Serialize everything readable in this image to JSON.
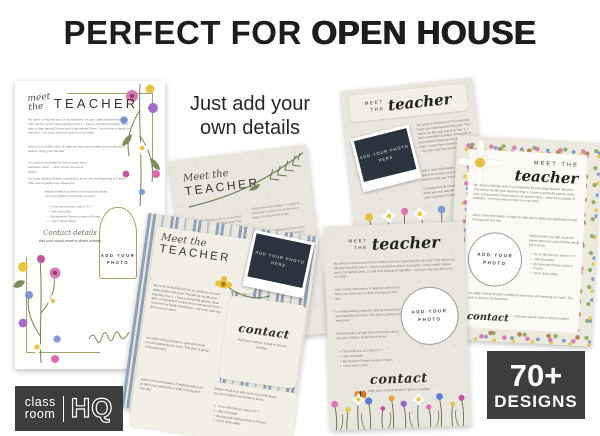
{
  "header": {
    "title_regular": "PERFECT FOR",
    "title_bold": "OPEN HOUSE"
  },
  "captions": {
    "just_add": "Just add your own details",
    "pages": "Pages of designs to choose from"
  },
  "badges": {
    "designs_count": "70+",
    "designs_label": "DESIGNS",
    "logo_top": "class",
    "logo_bottom": "room",
    "logo_hq": "HQ"
  },
  "placeholders": {
    "add_photo": "ADD YOUR PHOTO",
    "add_photo_here": "ADD YOUR PHOTO HERE"
  },
  "copy": {
    "intro": "My name is Nichola and I'm so excited to be your class teacher this year! This will be my 8th year teaching Year 1. I have a wonderful partner, three girls, a dog named Cooper and a cat named Clem. I come from a family of teachers – my mum was one and so is my sister.",
    "more_info": "Add in more information. It might be able how to label your textbooks or what to bring your first day.",
    "filler": "Just add more details And then some more and Even more ... Until you've run out of space.",
    "closing": "I'm really looking forward to getting to know you and watching you learn. This year is going to be awesome!",
    "dot_points": "Maybe break it up with some dot points about you your children would like to know",
    "bullets": [
      "I'm so tall now as I was in Yr 7",
      "I like chocolate",
      "My favourite Disney movie is Frozen",
      "I don't drink coffee"
    ],
    "contact_sub": "Add your school email or phone number"
  },
  "flyers": {
    "left": {
      "script_line1": "meet",
      "script_line2": "the",
      "caps": "TEACHER",
      "contact_label": "Contact details"
    },
    "mid": {
      "script": "Meet the",
      "caps": "TEACHER"
    },
    "striped": {
      "script": "Meet the",
      "caps": "TEACHER",
      "contact_label": "contact"
    },
    "topright": {
      "caps_line1": "MEET",
      "caps_line2": "THE",
      "script": "teacher"
    },
    "border": {
      "caps": "MEET THE",
      "script": "teacher",
      "contact_label": "contact"
    },
    "front": {
      "caps_line1": "MEET",
      "caps_line2": "THE",
      "script": "teacher",
      "contact_label": "contact"
    }
  },
  "colors": {
    "badge_bg": "#3d3d3d",
    "stripe_blue": "#91a1b8",
    "paper_beige": "#e9e6df",
    "panel_cream": "#f2efe7",
    "polaroid_dark": "#2c323e",
    "gold_frame": "#ab9f6a"
  }
}
